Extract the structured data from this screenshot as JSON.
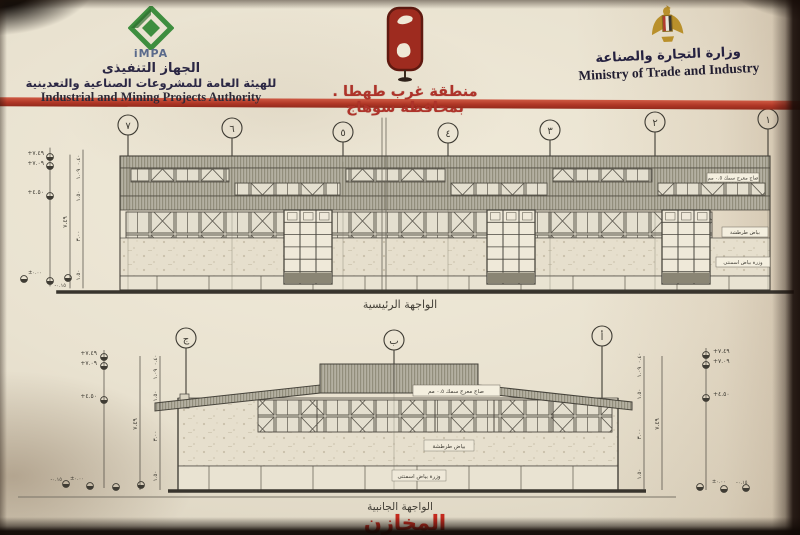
{
  "header": {
    "impa": {
      "logo": "iMPA",
      "title_ar": "الجهاز التنفيذى",
      "subtitle_ar": "للهيئة العامة للمشروعات الصناعية والتعدينية",
      "title_en": "Industrial and Mining Projects Authority"
    },
    "zone": {
      "title_ar": "منطقة غرب طهطا . بمحافظة سوهاج"
    },
    "ministry": {
      "title_ar": "وزارة التجارة والصناعة",
      "title_en": "Ministry of Trade and Industry"
    }
  },
  "main_elevation": {
    "caption": "الواجهة الرئيسية",
    "axes": [
      "٧",
      "٦",
      "٥",
      "٤",
      "٣",
      "٢",
      "١"
    ],
    "levels": {
      "ridge": "+٧.٤٩",
      "eave": "+٧.٠٩",
      "mid": "+٤.٥٠",
      "zero": "±٠.٠٠",
      "below": "-٠.١٥"
    },
    "chain": [
      "٠.٤٠",
      "١.٠٩",
      "١.٥٠",
      "٣.٠٠",
      "١.٥٠"
    ],
    "total": "٧.٤٩",
    "notes": {
      "roof": "صاج معرج سمك ٠.٥ مم",
      "wall": "بياض طرطشة",
      "base": "وزرة بياض اسمنتى"
    }
  },
  "side_elevation": {
    "caption": "الواجهة الجانبية",
    "axes": [
      "ج",
      "ب",
      "أ"
    ],
    "levels": {
      "ridge": "+٧.٤٩",
      "eave": "+٧.٠٩",
      "mid": "+٤.٥٠",
      "zero": "±٠.٠٠",
      "below": "-٠.١٥"
    },
    "chain": [
      "٠.٤٠",
      "١.٠٩",
      "١.٥٠",
      "٣.٠٠",
      "١.٥٠"
    ],
    "total": "٧.٤٩",
    "notes": {
      "roof": "صاج معرج سمك ٠.٥ مم",
      "wall": "بياض طرطشة",
      "base": "وزرة بياض اسمنتى"
    }
  },
  "footer": {
    "title_ar": "المخازن"
  }
}
